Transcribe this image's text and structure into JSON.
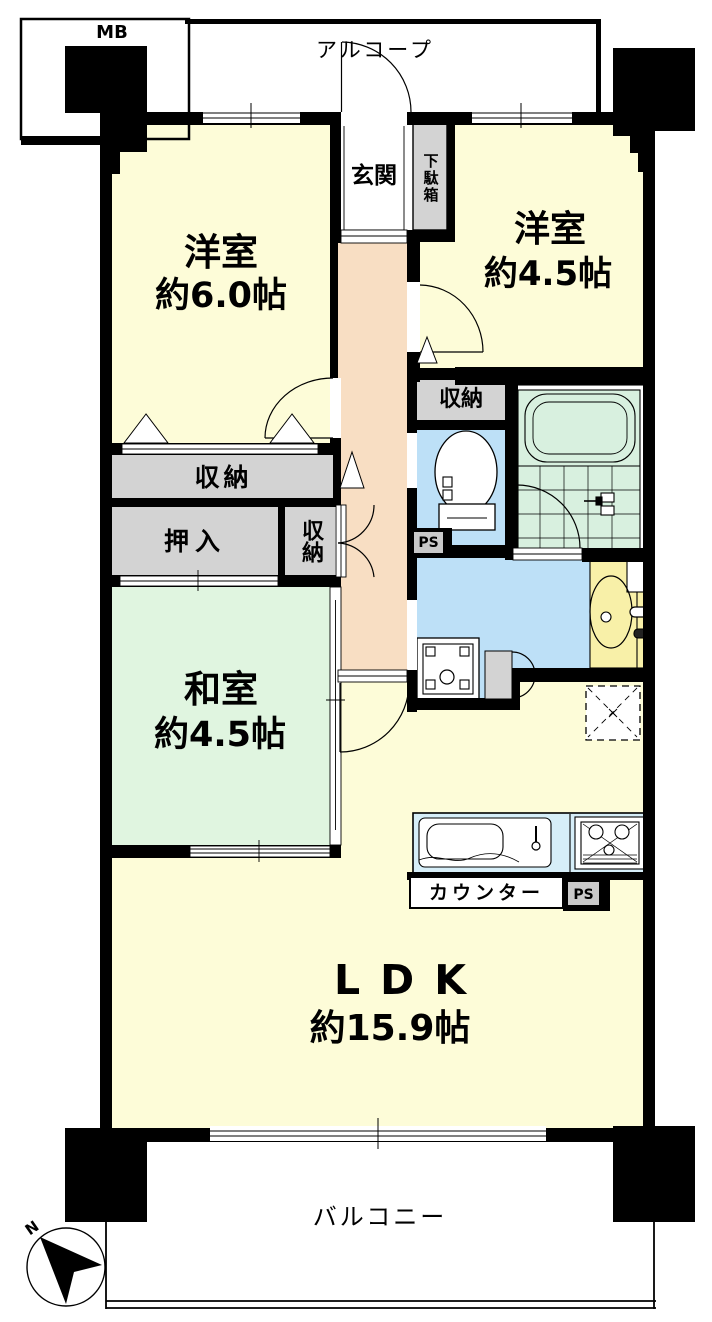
{
  "title": "apartment-floor-plan",
  "rooms": {
    "western1": {
      "label": "洋室",
      "size": "約6.0帖"
    },
    "western2": {
      "label": "洋室",
      "size": "約4.5帖"
    },
    "japanese": {
      "label": "和室",
      "size": "約4.5帖"
    },
    "ldk": {
      "label": "LDK",
      "size": "約15.9帖"
    }
  },
  "labels": {
    "mb": "MB",
    "alcove": "アルコープ",
    "entrance": "玄関",
    "shoe_cabinet": "下駄箱",
    "storage_hall": "収納",
    "storage_bedroom": "収納",
    "closet": "押入",
    "storage_small": "収納",
    "counter": "カウンター",
    "ps_toilet": "PS",
    "ps_kitchen": "PS",
    "balcony": "バルコニー",
    "north": "N"
  },
  "colors": {
    "wall": "#000000",
    "room_yellow": "#FDFCD8",
    "hall_peach": "#F8DEC3",
    "tatami_green": "#E0F5E0",
    "bath_green": "#D8F0DF",
    "wet_blue": "#BDE0F7",
    "kitchen_blue": "#D6EEF8",
    "storage_gray": "#D3D3D3",
    "vanity_yellow": "#F8F0A8"
  }
}
